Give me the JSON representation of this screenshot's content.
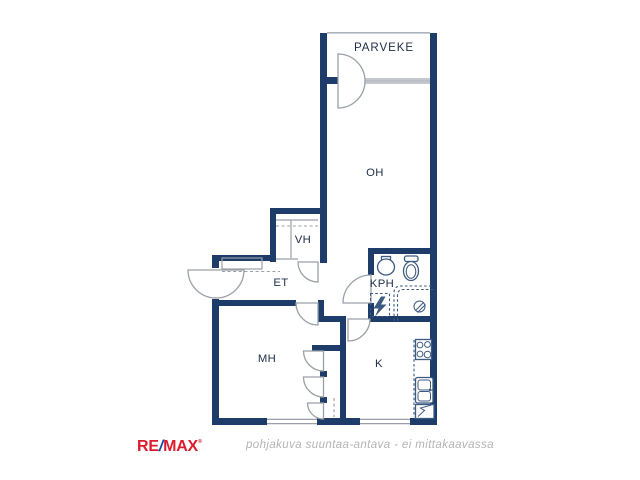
{
  "floorplan": {
    "rooms": [
      {
        "label": "PARVEKE"
      },
      {
        "label": "OH"
      },
      {
        "label": "VH"
      },
      {
        "label": "ET"
      },
      {
        "label": "KPH"
      },
      {
        "label": "MH"
      },
      {
        "label": "K"
      }
    ],
    "caption": "pohjakuva suuntaa-antava - ei mittakaavassa",
    "symbols": [
      "balcony-door",
      "balcony-window",
      "entry-door",
      "interior-door-swing",
      "closet-doors",
      "coat-rack",
      "closet-shelf",
      "washbasin",
      "toilet",
      "shower-area",
      "floor-drain",
      "washing-machine-reservation",
      "stove",
      "kitchen-sink",
      "refrigerator",
      "window"
    ]
  },
  "branding": {
    "logo": {
      "re": "RE",
      "slash": "/",
      "max": "MAX",
      "mark": "®"
    }
  },
  "colors": {
    "wall": "#1e3c6a",
    "line": "#9aa0a8",
    "fixture": "#3d5a80",
    "label": "#203049",
    "caption": "#b3b3b6",
    "logo_red": "#dc1c2e",
    "logo_blue": "#1746a0"
  }
}
